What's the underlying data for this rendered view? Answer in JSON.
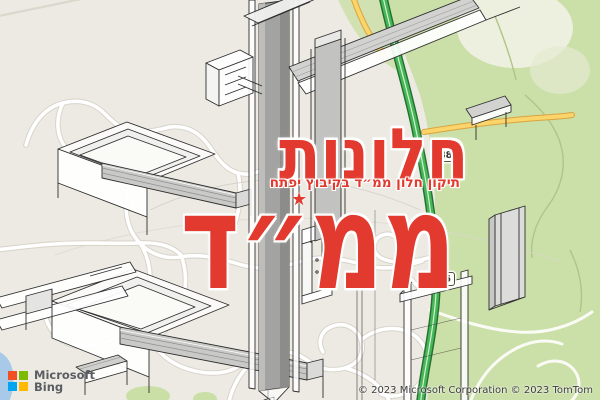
{
  "overlay": {
    "headline_line1": "חלונות",
    "headline_line2": "ממ״ד",
    "subtitle": "תיקון חלון ממ״ד בקיבוץ יפתח",
    "star_icon": "★",
    "text_color": "#e23a2e"
  },
  "map": {
    "road_shields": [
      {
        "number": "886"
      },
      {
        "number": "886"
      }
    ],
    "attribution": {
      "logo_line1": "Microsoft",
      "logo_line2": "Bing",
      "copyright": "© 2023 Microsoft Corporation © 2023 TomTom"
    },
    "colors": {
      "land": "#edeae3",
      "green_area": "#cbdfa8",
      "highway_green": "#44b655",
      "highway_casing": "#256f32",
      "secondary_road_yellow": "#fbd46b",
      "street_white": "#ffffff",
      "water": "#a9c9e8",
      "ms_square_tl": "#f25022",
      "ms_square_tr": "#7fba00",
      "ms_square_bl": "#00a4ef",
      "ms_square_br": "#ffb900"
    }
  }
}
